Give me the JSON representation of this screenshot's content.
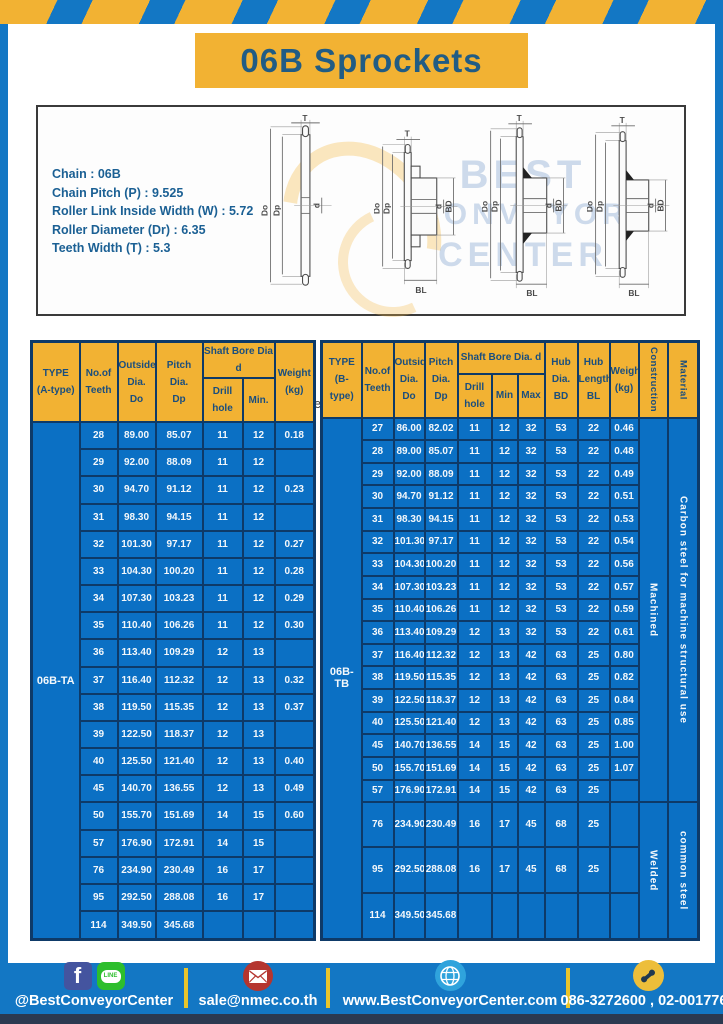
{
  "title": "06B Sprockets",
  "colors": {
    "frame_blue": "#1377C4",
    "accent_yellow": "#F2B233",
    "table_body_blue": "#0B70C4",
    "table_border_navy": "#0E3A68",
    "header_text_navy": "#1A4E7E",
    "title_text": "#215C84",
    "spec_text_blue": "#1B6094",
    "footer_strip": "#2B3950"
  },
  "diagram": {
    "spec_lines": [
      "Chain  : 06B",
      "Chain Pitch (P)  :  9.525",
      "Roller Link Inside Width (W)  :  5.72",
      "Roller Diameter (Dr)  : 6.35",
      "Teeth Width (T)  :  5.3"
    ],
    "captions": [
      "A-type",
      "B-type: Machined",
      "B-type: Welded",
      "C-type: Welded"
    ],
    "dims": {
      "T": "T",
      "Do": "Do",
      "Dp": "Dp",
      "d": "d",
      "BD": "BD",
      "BL": "BL"
    }
  },
  "watermark": {
    "lines": [
      "BEST",
      "CONVEYOR",
      "CENTER"
    ]
  },
  "tables": {
    "left": {
      "headers": {
        "type": [
          "TYPE",
          "(A-type)"
        ],
        "teeth": [
          "No.of",
          "Teeth"
        ],
        "outside": [
          "Outside",
          "Dia.",
          "Do"
        ],
        "pitch": [
          "Pitch Dia.",
          "Dp"
        ],
        "shaft_group": "Shaft Bore Dia d",
        "drill": "Drill hole",
        "min": "Min.",
        "weight": [
          "Weight",
          "(kg)"
        ]
      },
      "type_value": "06B-TA",
      "rows": [
        [
          "28",
          "89.00",
          "85.07",
          "11",
          "12",
          "0.18"
        ],
        [
          "29",
          "92.00",
          "88.09",
          "11",
          "12",
          ""
        ],
        [
          "30",
          "94.70",
          "91.12",
          "11",
          "12",
          "0.23"
        ],
        [
          "31",
          "98.30",
          "94.15",
          "11",
          "12",
          ""
        ],
        [
          "32",
          "101.30",
          "97.17",
          "11",
          "12",
          "0.27"
        ],
        [
          "33",
          "104.30",
          "100.20",
          "11",
          "12",
          "0.28"
        ],
        [
          "34",
          "107.30",
          "103.23",
          "11",
          "12",
          "0.29"
        ],
        [
          "35",
          "110.40",
          "106.26",
          "11",
          "12",
          "0.30"
        ],
        [
          "36",
          "113.40",
          "109.29",
          "12",
          "13",
          ""
        ],
        [
          "37",
          "116.40",
          "112.32",
          "12",
          "13",
          "0.32"
        ],
        [
          "38",
          "119.50",
          "115.35",
          "12",
          "13",
          "0.37"
        ],
        [
          "39",
          "122.50",
          "118.37",
          "12",
          "13",
          ""
        ],
        [
          "40",
          "125.50",
          "121.40",
          "12",
          "13",
          "0.40"
        ],
        [
          "45",
          "140.70",
          "136.55",
          "12",
          "13",
          "0.49"
        ],
        [
          "50",
          "155.70",
          "151.69",
          "14",
          "15",
          "0.60"
        ],
        [
          "57",
          "176.90",
          "172.91",
          "14",
          "15",
          ""
        ],
        [
          "76",
          "234.90",
          "230.49",
          "16",
          "17",
          ""
        ],
        [
          "95",
          "292.50",
          "288.08",
          "16",
          "17",
          ""
        ],
        [
          "114",
          "349.50",
          "345.68",
          "",
          "",
          ""
        ]
      ]
    },
    "right": {
      "headers": {
        "type": [
          "TYPE",
          "(B-type)"
        ],
        "teeth": [
          "No.of",
          "Teeth"
        ],
        "outside": [
          "Outside",
          "Dia.",
          "Do"
        ],
        "pitch": [
          "Pitch",
          "Dia.",
          "Dp"
        ],
        "shaft_group": "Shaft Bore Dia.  d",
        "drill": "Drill hole",
        "min": "Min",
        "max": "Max",
        "hub_dia": [
          "Hub",
          "Dia.",
          "BD"
        ],
        "hub_len": [
          "Hub",
          "Length",
          "BL"
        ],
        "weight": [
          "Weight",
          "(kg)"
        ],
        "construction": "Construction",
        "material": "Material"
      },
      "type_value": "06B-TB",
      "construction": [
        {
          "label": "Machined",
          "span": 17
        },
        {
          "label": "Welded",
          "span": 3
        }
      ],
      "material": [
        {
          "label": "Carbon steel for machine  structural use",
          "span": 17
        },
        {
          "label": "common steel",
          "span": 3
        }
      ],
      "rows": [
        [
          "27",
          "86.00",
          "82.02",
          "11",
          "12",
          "32",
          "53",
          "22",
          "0.46"
        ],
        [
          "28",
          "89.00",
          "85.07",
          "11",
          "12",
          "32",
          "53",
          "22",
          "0.48"
        ],
        [
          "29",
          "92.00",
          "88.09",
          "11",
          "12",
          "32",
          "53",
          "22",
          "0.49"
        ],
        [
          "30",
          "94.70",
          "91.12",
          "11",
          "12",
          "32",
          "53",
          "22",
          "0.51"
        ],
        [
          "31",
          "98.30",
          "94.15",
          "11",
          "12",
          "32",
          "53",
          "22",
          "0.53"
        ],
        [
          "32",
          "101.30",
          "97.17",
          "11",
          "12",
          "32",
          "53",
          "22",
          "0.54"
        ],
        [
          "33",
          "104.30",
          "100.20",
          "11",
          "12",
          "32",
          "53",
          "22",
          "0.56"
        ],
        [
          "34",
          "107.30",
          "103.23",
          "11",
          "12",
          "32",
          "53",
          "22",
          "0.57"
        ],
        [
          "35",
          "110.40",
          "106.26",
          "11",
          "12",
          "32",
          "53",
          "22",
          "0.59"
        ],
        [
          "36",
          "113.40",
          "109.29",
          "12",
          "13",
          "32",
          "53",
          "22",
          "0.61"
        ],
        [
          "37",
          "116.40",
          "112.32",
          "12",
          "13",
          "42",
          "63",
          "25",
          "0.80"
        ],
        [
          "38",
          "119.50",
          "115.35",
          "12",
          "13",
          "42",
          "63",
          "25",
          "0.82"
        ],
        [
          "39",
          "122.50",
          "118.37",
          "12",
          "13",
          "42",
          "63",
          "25",
          "0.84"
        ],
        [
          "40",
          "125.50",
          "121.40",
          "12",
          "13",
          "42",
          "63",
          "25",
          "0.85"
        ],
        [
          "45",
          "140.70",
          "136.55",
          "14",
          "15",
          "42",
          "63",
          "25",
          "1.00"
        ],
        [
          "50",
          "155.70",
          "151.69",
          "14",
          "15",
          "42",
          "63",
          "25",
          "1.07"
        ],
        [
          "57",
          "176.90",
          "172.91",
          "14",
          "15",
          "42",
          "63",
          "25",
          ""
        ],
        [
          "76",
          "234.90",
          "230.49",
          "16",
          "17",
          "45",
          "68",
          "25",
          ""
        ],
        [
          "95",
          "292.50",
          "288.08",
          "16",
          "17",
          "45",
          "68",
          "25",
          ""
        ],
        [
          "114",
          "349.50",
          "345.68",
          "",
          "",
          "",
          "",
          "",
          ""
        ]
      ]
    }
  },
  "footer": {
    "social_handle": "@BestConveyorCenter",
    "line_label": "LINE",
    "facebook_label": "f",
    "email": "sale@nmec.co.th",
    "website": "www.BestConveyorCenter.com",
    "phones": "086-3272600 , 02-0017766"
  }
}
